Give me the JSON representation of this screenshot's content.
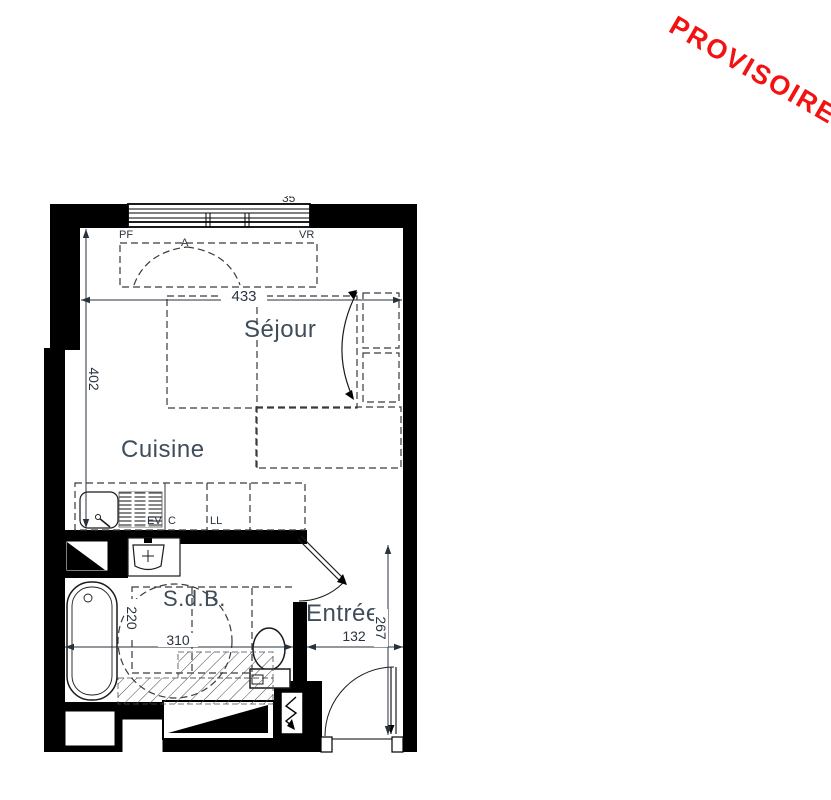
{
  "stamp": {
    "label": "PROVISOIRE",
    "color": "#f31111"
  },
  "plan": {
    "rooms": {
      "sejour": "Séjour",
      "cuisine": "Cuisine",
      "sdb": "S.d.B.",
      "entree": "Entrée"
    },
    "dimensions": {
      "sejour_width": "433",
      "sejour_height": "402",
      "sdb_width": "310",
      "sdb_depth": "220",
      "entree_width": "132",
      "entree_depth": "267",
      "window_cut": "35"
    },
    "tags": {
      "window_left": "PF",
      "window_right": "VR",
      "window_swing": "A",
      "sink": "EV",
      "cooktop": "C",
      "washer": "LL"
    }
  },
  "colors": {
    "wall": "#000000",
    "room_label": "#3f4c5a",
    "dimension": "#2a3440"
  }
}
